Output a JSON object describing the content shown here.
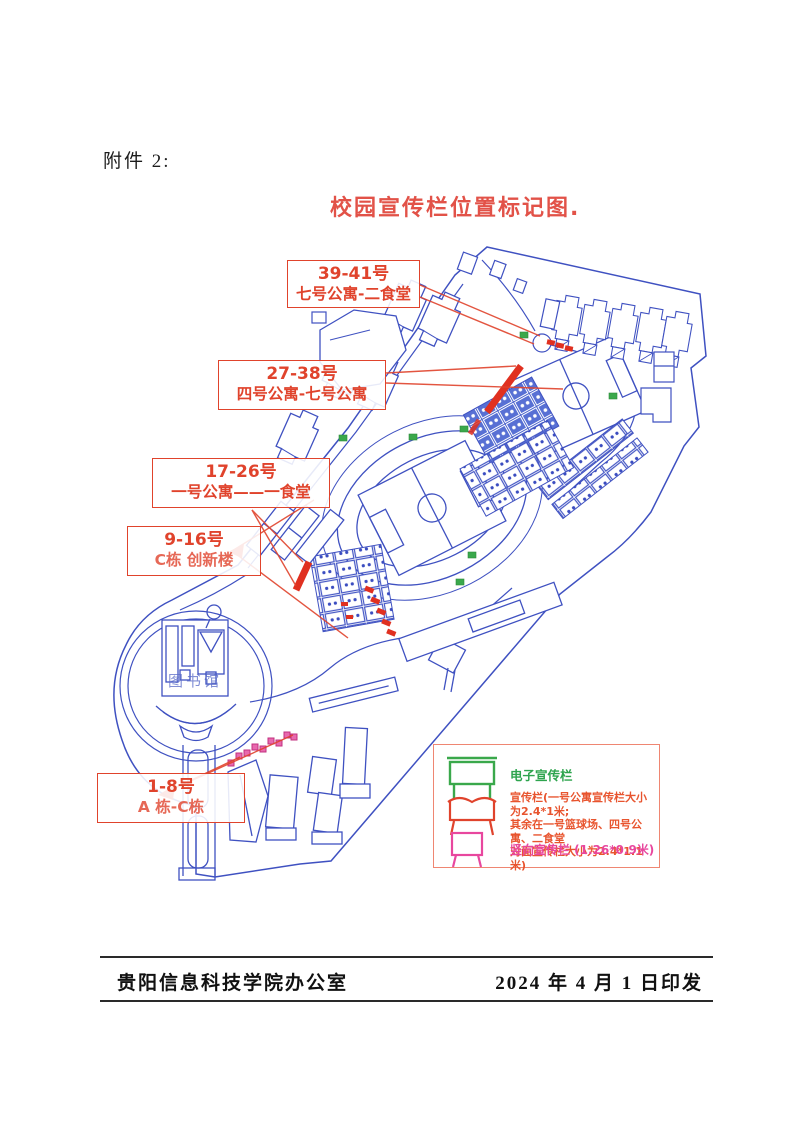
{
  "page": {
    "attachment_label": "附件 2:",
    "title": "校园宣传栏位置标记图."
  },
  "annotations": [
    {
      "line1": "39-41号",
      "line2": "七号公寓-二食堂"
    },
    {
      "line1": "27-38号",
      "line2": "四号公寓-七号公寓"
    },
    {
      "line1": "17-26号",
      "line2": "一号公寓——一食堂"
    },
    {
      "line1": "9-16号",
      "line2": "C栋  创新楼"
    },
    {
      "line1": "1-8号",
      "line2": "A 栋-C栋"
    }
  ],
  "map": {
    "library_label": "图书馆"
  },
  "legend": {
    "electronic_label": "电子宣传栏",
    "standard_line1": "宣传栏(一号公寓宣传栏大小为2.4*1米;",
    "standard_line2": "其余在一号篮球场、四号公寓、二食堂",
    "standard_line3": "对面宣传栏大小为2.4*1.1米)",
    "vertical_label": "竖向宣传栏 (1.26*0.9米)"
  },
  "footer": {
    "office": "贵阳信息科技学院办公室",
    "date": "2024 年 4 月 1 日印发"
  },
  "colors": {
    "map_blue": "#3f51c1",
    "annotation_red": "#e0432c",
    "legend_green": "#2ea44e",
    "legend_orange": "#e8542e",
    "legend_pink": "#e8479e"
  }
}
